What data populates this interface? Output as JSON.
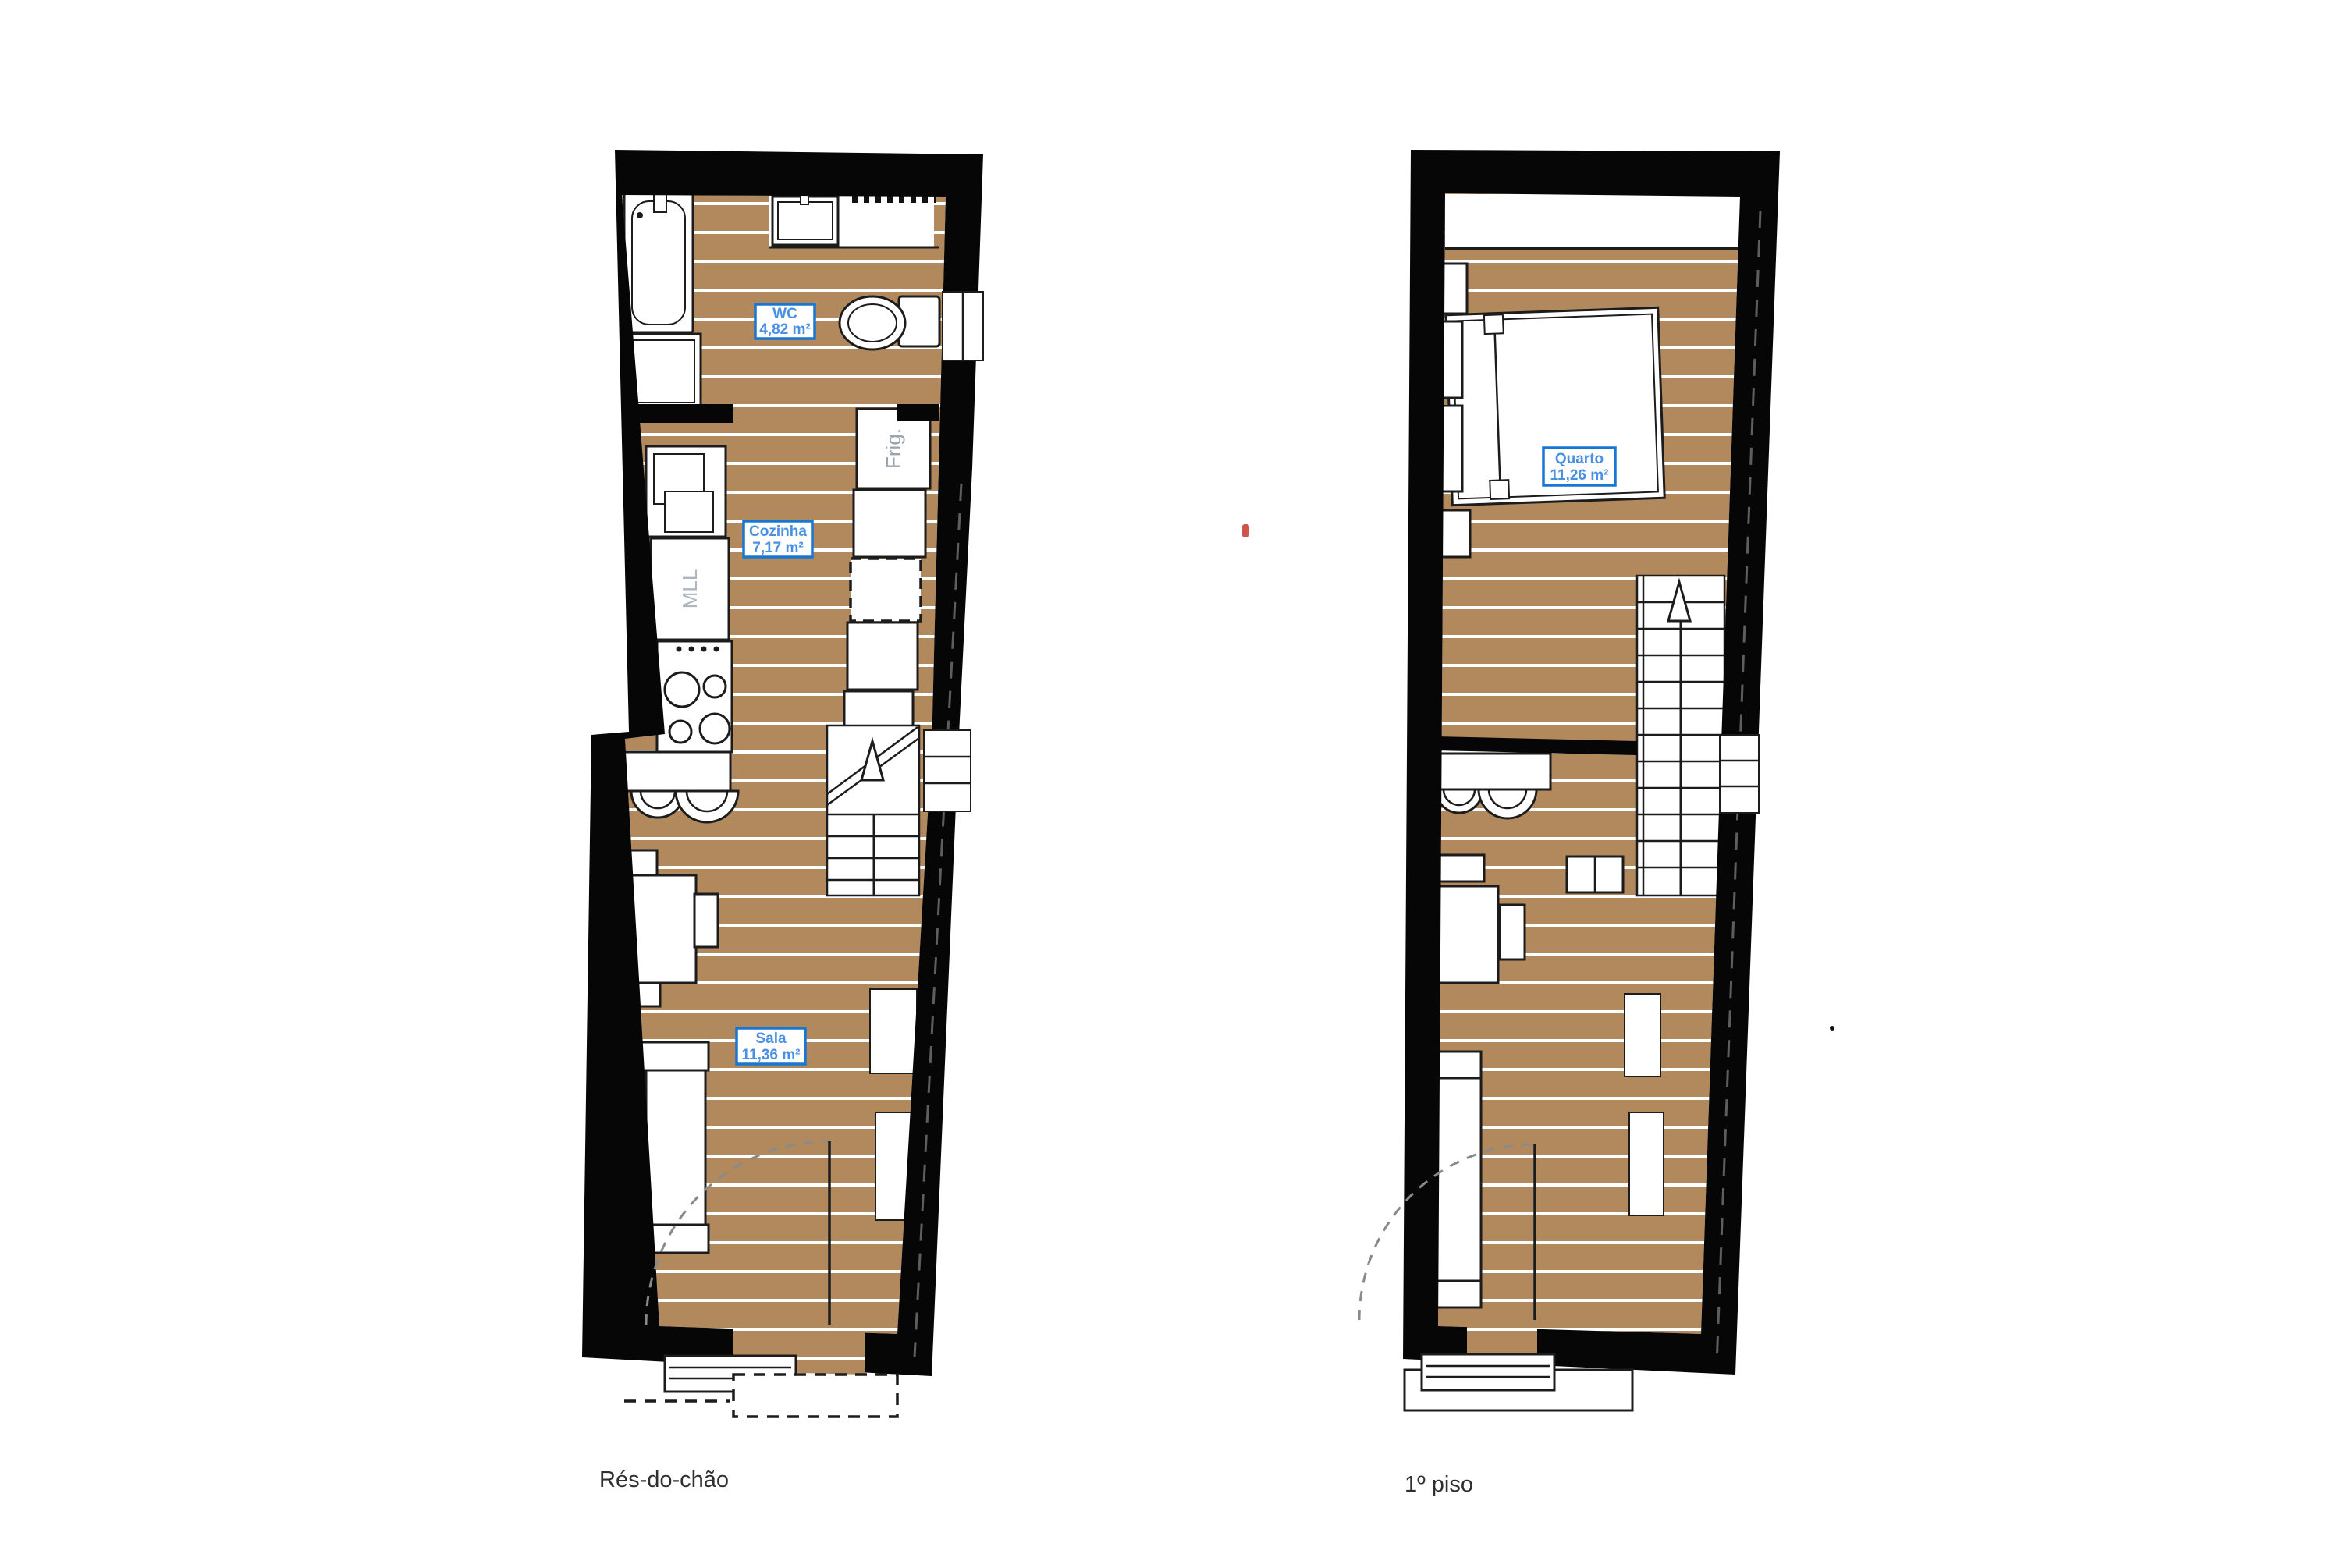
{
  "colors": {
    "floor": "#B1895C",
    "plank_line": "#FFFFFF",
    "wall": "#060606",
    "label_border": "#1877D2",
    "label_text": "#4A90E2",
    "caption_text": "#2F2F2F",
    "fridge_text": "#9AA3AC",
    "dishwasher_text": "#AEB6C0",
    "red_mark": "#D0544A"
  },
  "plans": [
    {
      "caption": "Rés-do-chão",
      "rooms": [
        {
          "name": "WC",
          "area": "4,82 m²"
        },
        {
          "name": "Cozinha",
          "area": "7,17 m²"
        },
        {
          "name": "Sala",
          "area": "11,36 m²"
        }
      ],
      "labels": {
        "fridge": "Frig.",
        "dishwasher": "MLL"
      }
    },
    {
      "caption": "1º piso",
      "rooms": [
        {
          "name": "Quarto",
          "area": "11,26 m²"
        }
      ]
    }
  ]
}
